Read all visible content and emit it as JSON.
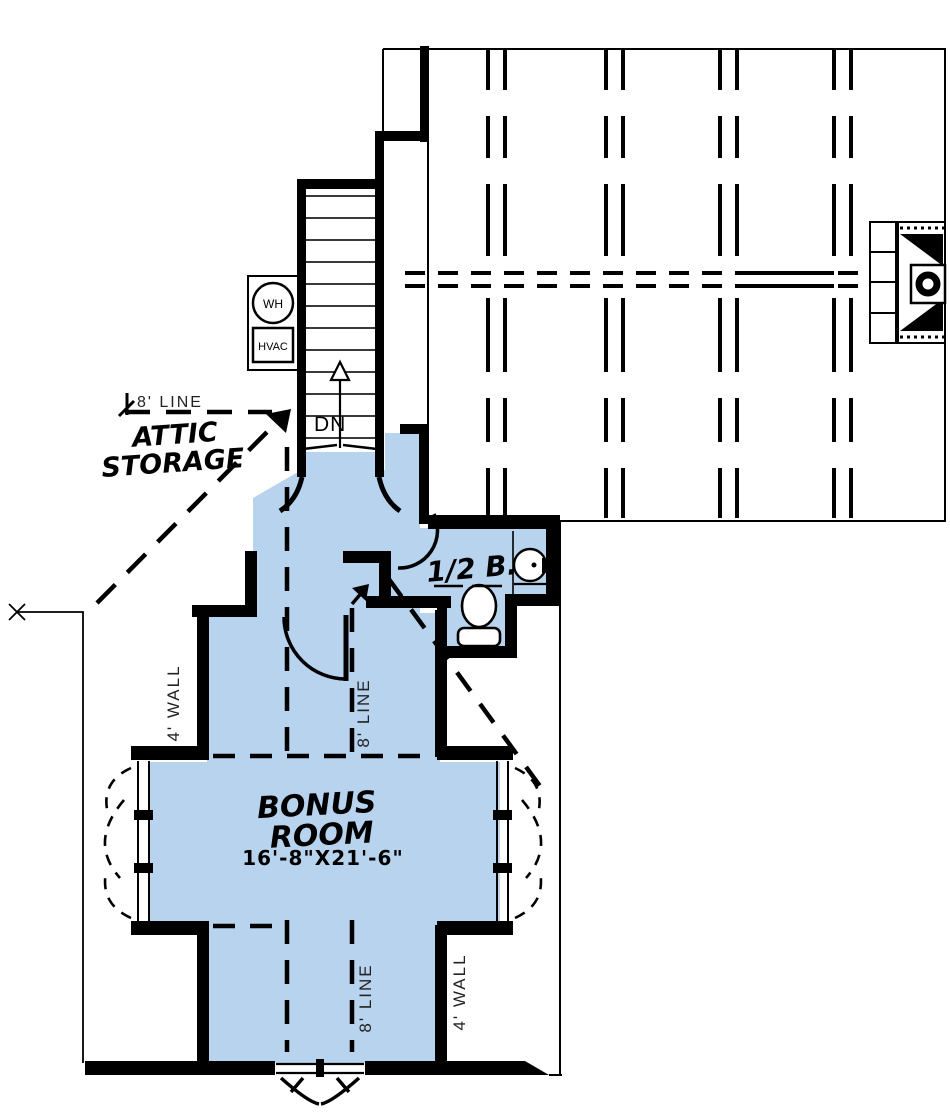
{
  "plan": {
    "stairs": {
      "direction_label": "DN"
    },
    "equipment": {
      "water_heater": "WH",
      "hvac": "HVAC"
    },
    "attic": {
      "line_label": "8' LINE",
      "storage_line1": "ATTIC",
      "storage_line2": "STORAGE"
    },
    "bath": {
      "label": "1/2 B."
    },
    "bonus_room": {
      "name_line1": "BONUS",
      "name_line2": "ROOM",
      "dimensions": "16'-8\"X21'-6\""
    },
    "annotations": {
      "wall_4_left": "4' WALL",
      "line_8_center": "8' LINE",
      "wall_4_right": "4' WALL",
      "line_8_bottom": "8' LINE"
    },
    "colors": {
      "floor": "#b7d3ed",
      "wall": "#000000",
      "tread": "#3a3a3a",
      "background": "#ffffff"
    }
  }
}
